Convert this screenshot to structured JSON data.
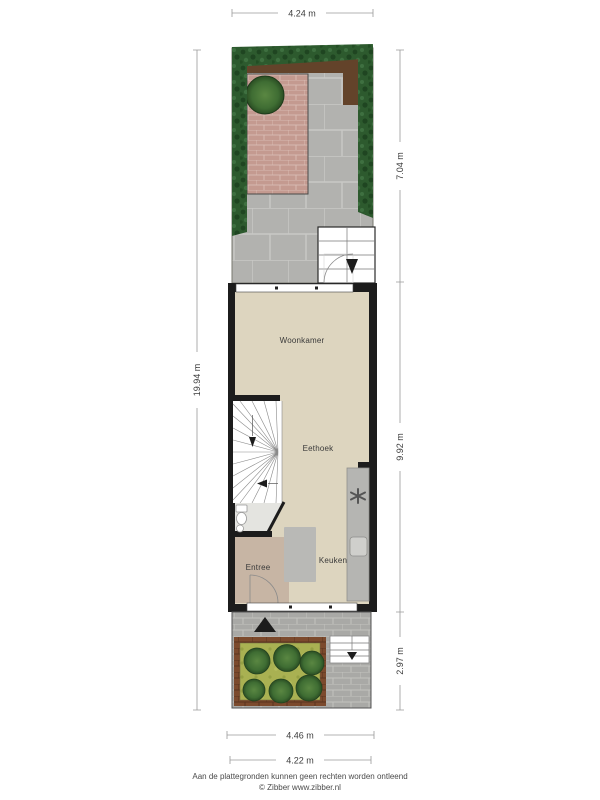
{
  "floorplan": {
    "dimensions": {
      "top_width": "4.24 m",
      "total_depth": "19.94 m",
      "back_garden_depth": "7.04 m",
      "house_depth": "9.92 m",
      "front_garden_depth": "2.97 m",
      "house_width": "4.46 m",
      "plot_width": "4.22 m"
    },
    "rooms": {
      "woonkamer": {
        "label": "Woonkamer"
      },
      "eethoek": {
        "label": "Eethoek"
      },
      "keuken": {
        "label": "Keuken"
      },
      "entree": {
        "label": "Entree"
      }
    },
    "colors": {
      "wall": "#1c1c1c",
      "floor": "#ddd5bf",
      "entree_floor": "#c7b5a4",
      "toilet_floor": "#e4e4e0",
      "counter_gray": "#b5b5b2",
      "paving_gray": "#b2b2af",
      "paving_joint": "#c9c9c6",
      "brick_gray": "#a9a9a6",
      "brick_joint": "#c2c2bf",
      "hedge_green": "#2d5a2e",
      "hedge_dark": "#1f4521",
      "hedge_light": "#3e7040",
      "grass_green": "#a9b152",
      "grass_dark": "#96a144",
      "bush_green": "#3f6d33",
      "dirt_brown": "#63432a",
      "patio_brick": "#c49a90",
      "patio_joint": "#dcc2ba",
      "bed_brick": "#7c4a2d",
      "bed_joint": "#5a3420",
      "dimension_line": "#9a9a9a",
      "text": "#3c3c3c"
    }
  },
  "footer": {
    "disclaimer": "Aan de plattegronden kunnen geen rechten worden ontleend",
    "credit": "© Zibber www.zibber.nl"
  }
}
